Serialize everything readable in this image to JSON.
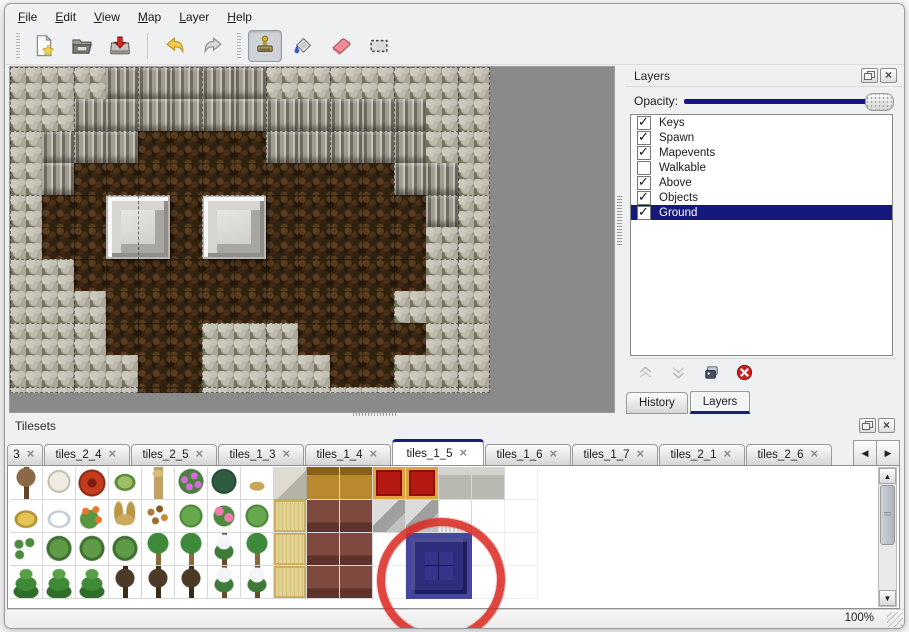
{
  "window": {
    "status_zoom": "100%"
  },
  "menubar": {
    "items": [
      "File",
      "Edit",
      "View",
      "Map",
      "Layer",
      "Help"
    ]
  },
  "toolbar": {
    "items": [
      {
        "type": "handle"
      },
      {
        "type": "button",
        "icon": "new-file"
      },
      {
        "type": "button",
        "icon": "open-folder"
      },
      {
        "type": "button",
        "icon": "save"
      },
      {
        "type": "separator"
      },
      {
        "type": "button",
        "icon": "undo"
      },
      {
        "type": "button",
        "icon": "redo"
      },
      {
        "type": "handle"
      },
      {
        "type": "button",
        "icon": "stamp",
        "active": true
      },
      {
        "type": "button",
        "icon": "fill-bucket"
      },
      {
        "type": "button",
        "icon": "eraser"
      },
      {
        "type": "button",
        "icon": "rect-select"
      }
    ],
    "active_tool": "stamp"
  },
  "map": {
    "tile_size": 32,
    "grid_step": 64,
    "legend": {
      "P": "pale-rock",
      "C": "cliff-wall",
      "B": "dark-floor"
    },
    "rows": [
      "PPPCCCCCPPPPPPP",
      "PPCCCCCCCCCCCPP",
      "PCCCBBBBCCCCCPP",
      "PCBBBBBBBBBBCCP",
      "PBBBBBBBBBBBBCP",
      "PBBBBBBBBBBBBPP",
      "PPBBBBBBBBBBBPP",
      "PPPBBBBBBBBBPPP",
      "PPPBBBPPPBBBBPP",
      "PPPPBBPPPPBBPPP",
      "PPPPBBPPPPPPPPP"
    ],
    "blocks": [
      {
        "col": 3,
        "row": 4
      },
      {
        "col": 6,
        "row": 4
      }
    ]
  },
  "layers_panel": {
    "title": "Layers",
    "opacity_label": "Opacity:",
    "opacity_percent": 100,
    "layers": [
      {
        "name": "Keys",
        "checked": true
      },
      {
        "name": "Spawn",
        "checked": true
      },
      {
        "name": "Mapevents",
        "checked": true
      },
      {
        "name": "Walkable",
        "checked": false
      },
      {
        "name": "Above",
        "checked": true
      },
      {
        "name": "Objects",
        "checked": true
      },
      {
        "name": "Ground",
        "checked": true,
        "selected": true
      }
    ],
    "actions": [
      {
        "icon": "layer-up",
        "disabled": true
      },
      {
        "icon": "layer-down",
        "disabled": true
      },
      {
        "icon": "layer-duplicate",
        "disabled": false
      },
      {
        "icon": "layer-delete",
        "disabled": false
      }
    ],
    "dock_tabs": [
      {
        "label": "History",
        "active": false
      },
      {
        "label": "Layers",
        "active": true
      }
    ]
  },
  "tilesets_panel": {
    "title": "Tilesets",
    "tabs": [
      {
        "label": "3",
        "truncated": true
      },
      {
        "label": "tiles_2_4"
      },
      {
        "label": "tiles_2_5"
      },
      {
        "label": "tiles_1_3"
      },
      {
        "label": "tiles_1_4"
      },
      {
        "label": "tiles_1_5",
        "active": true
      },
      {
        "label": "tiles_1_6"
      },
      {
        "label": "tiles_1_7"
      },
      {
        "label": "tiles_2_1"
      },
      {
        "label": "tiles_2_6"
      }
    ],
    "tile_rows": [
      [
        "tree_dead",
        "shrub_white",
        "flower_red_big",
        "stump_green",
        "trunk_tan",
        "bush_purple",
        "fern_dark",
        "weed_tan",
        "stone_tile",
        "wood_tile",
        "wood_tile",
        "carpet_red",
        "carpet_red",
        "gray_tile",
        "gray_tile",
        "blank"
      ],
      [
        "hay_mound",
        "snow_mound",
        "flowers_orange",
        "grass_dry",
        "leaves",
        "lilypad",
        "flowers_pink",
        "lilypad",
        "tatami",
        "maroon_tile",
        "maroon_tile",
        "shelf_gray",
        "shelf_gray",
        "curtain_white",
        "blank",
        "blank"
      ],
      [
        "sprouts",
        "bush_green",
        "bush_green",
        "bush_green",
        "palm",
        "palm",
        "conifer_snow",
        "palm",
        "tatami",
        "maroon_tile",
        "maroon_tile",
        "blank",
        "blank",
        "curtain_white",
        "blank",
        "blank"
      ],
      [
        "conifer",
        "conifer",
        "conifer",
        "tree_dark",
        "tree_dark",
        "tree_dark",
        "conifer_snow",
        "conifer_snow",
        "tatami",
        "maroon_tile",
        "maroon_tile",
        "blank",
        "blank",
        "curtain_white",
        "blank",
        "blank"
      ]
    ],
    "selected_tile": {
      "col": 12,
      "row": 2,
      "span_cols": 2,
      "span_rows": 2,
      "color": "#33348a"
    },
    "annotation": {
      "shape": "ellipse",
      "color": "#db2c26"
    }
  },
  "colors": {
    "accent_navy": "#15187c",
    "canvas_gray": "#8a8a8a",
    "annotation_red": "#db2c26"
  }
}
